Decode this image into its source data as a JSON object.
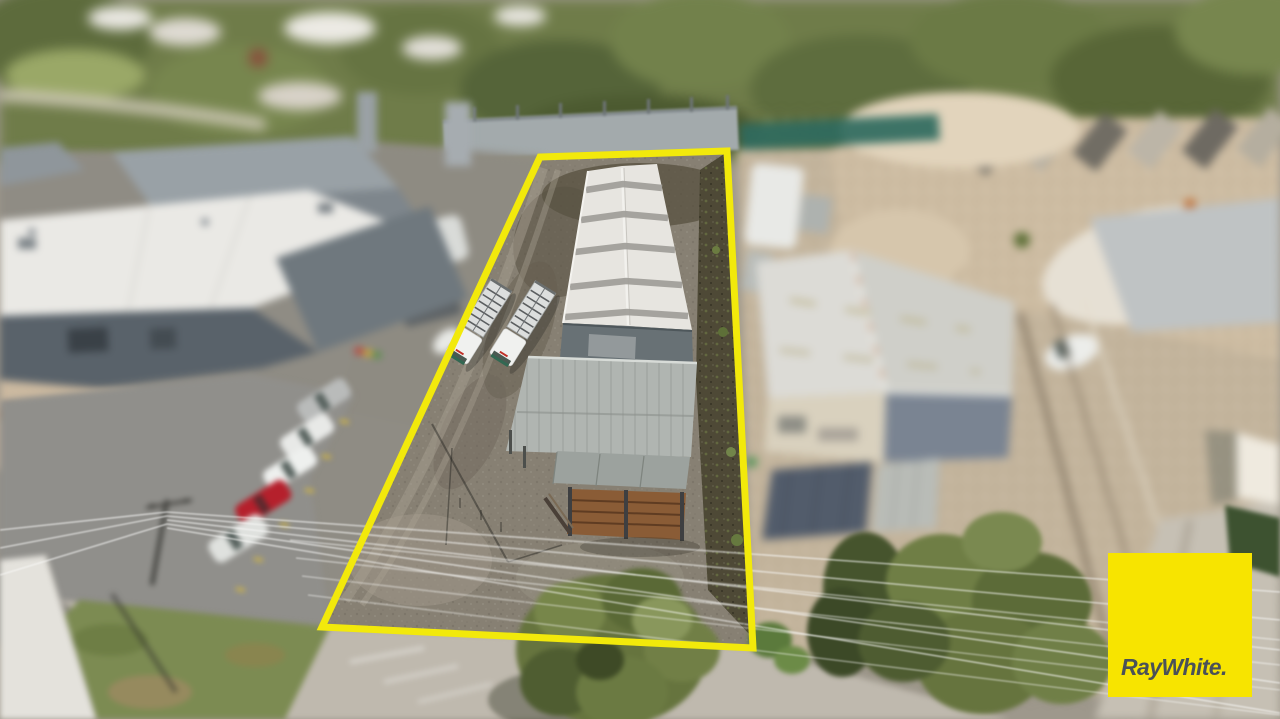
{
  "meta": {
    "type": "aerial-drone-photograph",
    "style": "tilt-shift real-estate listing photo, industrial properties"
  },
  "watermark": {
    "brand": "RayWhite."
  },
  "colors": {
    "logo-bg": "#F7E400",
    "logo-text": "#4A5158",
    "boundary-yellow": "#F2E90B",
    "shed-roof-white": "#E7E5E0",
    "shed-wall-grey": "#687175",
    "awning-grey": "#B0B5B1",
    "timber-brown": "#8A5C36",
    "gravel": "#878073",
    "asphalt": "#908F8B",
    "road": "#BFB9AE",
    "grass": "#7C8B52",
    "tree-olive": "#6F7C49",
    "demo-sand": "#C3B49C",
    "teal-fence": "#2F6A5E",
    "neighbour-roof": "#DCDBD6",
    "neighbour-gable": "#7A8492",
    "red-car": "#B5202C"
  },
  "scene": {
    "highlighted_property": {
      "outline_color": "bright yellow",
      "outline_corners_px": [
        [
          540,
          157
        ],
        [
          727,
          151
        ],
        [
          753,
          648
        ],
        [
          322,
          627
        ]
      ],
      "outline_stroke_px": 7,
      "contents": [
        "long white gable-roof shed with five skylight strips",
        "dark grey gable front wall with roller door",
        "grey skillion awning / carport",
        "timber-slat storage bays with grey roof",
        "two white cab-over trucks with rack trays",
        "gravel yard with tyre tracks",
        "dark mulch strip along right boundary",
        "large green street tree at frontage"
      ],
      "truck_count": 2
    },
    "surroundings": {
      "top": "dense blurred gum trees, white houses and lawn beyond top-left",
      "left": "grey warehouse with white roof, rear gable building, angled parking row",
      "parked_cars_left": [
        "white",
        "white",
        "white",
        "red",
        "white van"
      ],
      "bottom_left": "power pole with radiating overhead lines, grass nature strip, footpath, road",
      "right": "teal shade-cloth fence, cleared demolition block with sandy rubble, cream warehouse with blue-grey gable and dark-blue lean-to, large blurred trees and road at far right"
    }
  }
}
